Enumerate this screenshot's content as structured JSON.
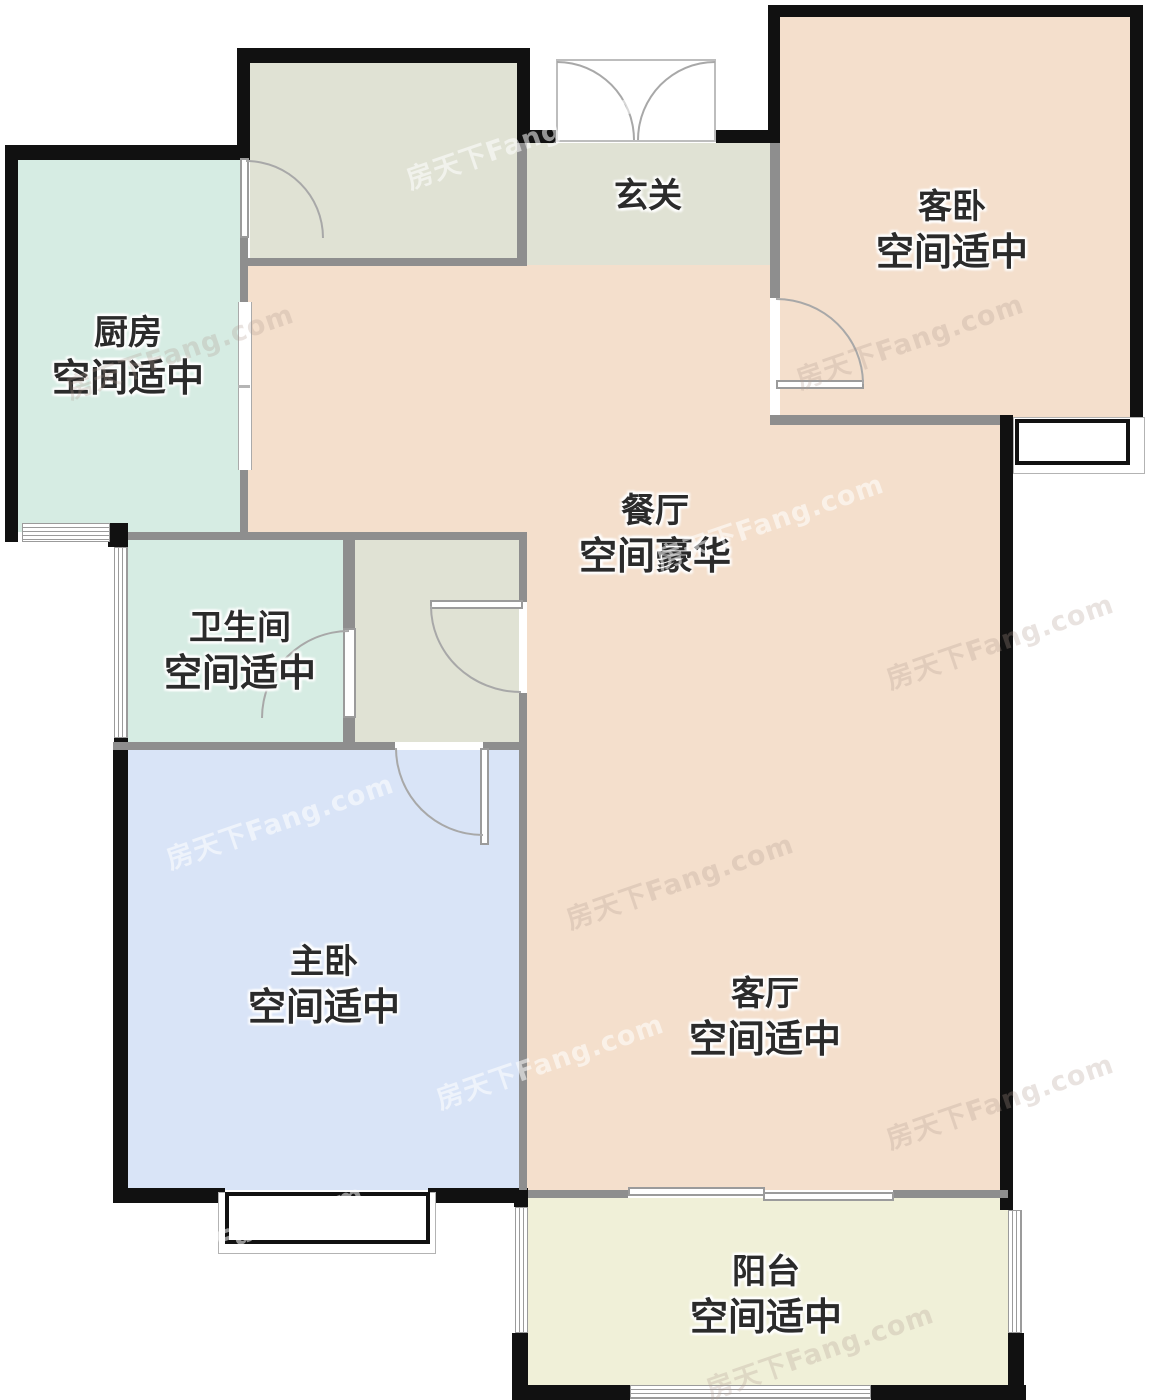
{
  "watermark": {
    "text": "房天下Fang.com"
  },
  "rooms": {
    "foyer": {
      "name": "玄关",
      "status": ""
    },
    "guest_bedroom": {
      "name": "客卧",
      "status": "空间适中"
    },
    "kitchen": {
      "name": "厨房",
      "status": "空间适中"
    },
    "dining": {
      "name": "餐厅",
      "status": "空间豪华"
    },
    "bathroom": {
      "name": "卫生间",
      "status": "空间适中"
    },
    "master_bedroom": {
      "name": "主卧",
      "status": "空间适中"
    },
    "living_room": {
      "name": "客厅",
      "status": "空间适中"
    },
    "balcony": {
      "name": "阳台",
      "status": "空间适中"
    }
  },
  "colors": {
    "exterior_wall": "#111111",
    "partition_wall": "#8e8e8e",
    "living_dining_fill": "#f4dfcc",
    "guest_bedroom_fill": "#f4dfcc",
    "hallway_fill": "#e0e2d4",
    "kitchen_bathroom_fill": "#d6ece3",
    "master_bedroom_fill": "#d9e4f7",
    "balcony_fill": "#f0f0d8",
    "label_text": "#2b2b2b",
    "door_arc": "#a8a8a8"
  }
}
